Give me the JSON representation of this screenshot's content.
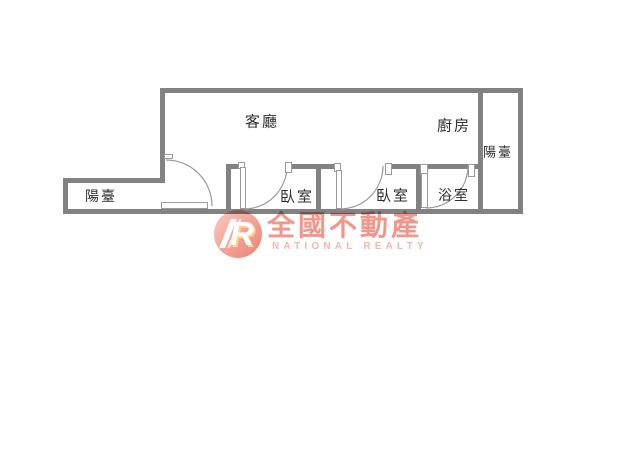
{
  "floorplan": {
    "wall_color": "#828282",
    "line_color": "#9b9b9b",
    "label_color": "#2e2e2e",
    "rooms": [
      {
        "id": "living-room",
        "label": "客廳",
        "x": 262,
        "y": 121,
        "size": 15
      },
      {
        "id": "kitchen",
        "label": "廚房",
        "x": 454,
        "y": 125,
        "size": 15
      },
      {
        "id": "balcony-right",
        "label": "陽臺",
        "x": 498,
        "y": 151,
        "size": 13
      },
      {
        "id": "balcony-left",
        "label": "陽臺",
        "x": 101,
        "y": 196,
        "size": 14
      },
      {
        "id": "bedroom-1",
        "label": "臥室",
        "x": 297,
        "y": 196,
        "size": 15
      },
      {
        "id": "bedroom-2",
        "label": "臥室",
        "x": 393,
        "y": 195,
        "size": 15
      },
      {
        "id": "bathroom",
        "label": "浴室",
        "x": 454,
        "y": 195,
        "size": 14
      }
    ],
    "walls": [
      {
        "id": "top",
        "x": 160,
        "y": 88,
        "w": 363,
        "h": 5
      },
      {
        "id": "living-left",
        "x": 160,
        "y": 88,
        "w": 5,
        "h": 95
      },
      {
        "id": "balcony-left-top",
        "x": 63,
        "y": 178,
        "w": 102,
        "h": 5
      },
      {
        "id": "balcony-left-wall",
        "x": 63,
        "y": 178,
        "w": 5,
        "h": 36
      },
      {
        "id": "bottom",
        "x": 63,
        "y": 209,
        "w": 460,
        "h": 5
      },
      {
        "id": "right-outer",
        "x": 518,
        "y": 88,
        "w": 5,
        "h": 126
      },
      {
        "id": "balcony-right-left",
        "x": 478,
        "y": 88,
        "w": 5,
        "h": 126
      },
      {
        "id": "kitchen-bath-top",
        "x": 416,
        "y": 164,
        "w": 67,
        "h": 5
      },
      {
        "id": "bed1-top-left",
        "x": 226,
        "y": 164,
        "w": 14,
        "h": 5
      },
      {
        "id": "bed1-top-right",
        "x": 291,
        "y": 164,
        "w": 45,
        "h": 5
      },
      {
        "id": "bed2-top-right",
        "x": 392,
        "y": 164,
        "w": 29,
        "h": 5
      },
      {
        "id": "bed1-left",
        "x": 226,
        "y": 164,
        "w": 5,
        "h": 50
      },
      {
        "id": "bed1-bed2-divider",
        "x": 316,
        "y": 164,
        "w": 5,
        "h": 50
      },
      {
        "id": "bed2-bath-divider",
        "x": 416,
        "y": 164,
        "w": 5,
        "h": 50
      }
    ],
    "door_jambs": [
      {
        "id": "entry-top",
        "x": 164,
        "y": 154,
        "w": 9,
        "h": 5
      },
      {
        "id": "bed1-left",
        "x": 238,
        "y": 162,
        "w": 7,
        "h": 7
      },
      {
        "id": "bed1-right",
        "x": 285,
        "y": 162,
        "w": 7,
        "h": 11
      },
      {
        "id": "bed2-left",
        "x": 334,
        "y": 163,
        "w": 7,
        "h": 9
      },
      {
        "id": "bed2-right",
        "x": 385,
        "y": 163,
        "w": 7,
        "h": 12
      },
      {
        "id": "bath-left",
        "x": 420,
        "y": 164,
        "w": 8,
        "h": 11
      },
      {
        "id": "bath-right",
        "x": 468,
        "y": 164,
        "w": 7,
        "h": 13
      }
    ],
    "door_leaves": [
      {
        "id": "entry",
        "x": 161,
        "y": 202,
        "w": 47,
        "h": 7
      },
      {
        "id": "bed1",
        "x": 240,
        "y": 167,
        "w": 6,
        "h": 42
      },
      {
        "id": "bed2",
        "x": 336,
        "y": 170,
        "w": 6,
        "h": 39
      },
      {
        "id": "bath",
        "x": 421,
        "y": 173,
        "w": 7,
        "h": 35
      }
    ],
    "door_arcs": [
      {
        "id": "entry",
        "path": "M 166 160 A 46 46 0 0 1 212 206"
      },
      {
        "id": "bed1",
        "path": "M 244 209 A 43 43 0 0 0 287 166"
      },
      {
        "id": "bed2",
        "path": "M 340 209 A 43 43 0 0 0 383 166"
      },
      {
        "id": "bath",
        "path": "M 426 208 A 42 42 0 0 0 468 167"
      }
    ]
  },
  "watermark": {
    "logo_monogram": "R",
    "brand": "全國不動產",
    "subbrand": "NATIONAL REALTY",
    "brand_color": "#f2968c",
    "subbrand_color": "#f6b6ae"
  }
}
